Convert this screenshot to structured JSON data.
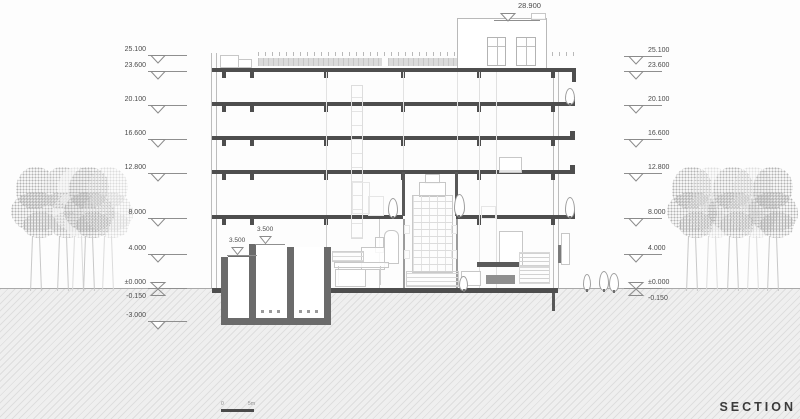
{
  "title": {
    "section_label": "SECTION"
  },
  "scalebar": {
    "start": "0",
    "end": "5m"
  },
  "roof_marker": {
    "label": "28.900"
  },
  "elevations": {
    "left": [
      {
        "label": "25.100",
        "y": 56,
        "sym": "tri"
      },
      {
        "label": "23.600",
        "y": 72,
        "sym": "tri"
      },
      {
        "label": "20.100",
        "y": 106,
        "sym": "tri"
      },
      {
        "label": "16.600",
        "y": 140,
        "sym": "tri"
      },
      {
        "label": "12.800",
        "y": 174,
        "sym": "tri"
      },
      {
        "label": "8.000",
        "y": 219,
        "sym": "tri"
      },
      {
        "label": "4.000",
        "y": 255,
        "sym": "tri"
      },
      {
        "label": "±0.000",
        "y": 289,
        "sym": "x"
      },
      {
        "label": "-0.150",
        "y": 303,
        "sym": "none"
      },
      {
        "label": "-3.000",
        "y": 322,
        "sym": "tri"
      }
    ],
    "right": [
      {
        "label": "25.100",
        "y": 57,
        "sym": "tri"
      },
      {
        "label": "23.600",
        "y": 72,
        "sym": "tri"
      },
      {
        "label": "20.100",
        "y": 106,
        "sym": "tri"
      },
      {
        "label": "16.600",
        "y": 140,
        "sym": "tri"
      },
      {
        "label": "12.800",
        "y": 174,
        "sym": "tri"
      },
      {
        "label": "8.000",
        "y": 219,
        "sym": "tri"
      },
      {
        "label": "4.000",
        "y": 255,
        "sym": "tri"
      },
      {
        "label": "±0.000",
        "y": 289,
        "sym": "x"
      },
      {
        "label": "-0.150",
        "y": 305,
        "sym": "none"
      }
    ],
    "interior": [
      {
        "label": "3.500",
        "x": 241,
        "liney": 256
      },
      {
        "label": "3.500",
        "x": 269,
        "liney": 245
      }
    ]
  },
  "colors": {
    "slab": "#4e4e4e",
    "basement_wall": "#6b6b6b",
    "ground_hatch": "#dedede",
    "text": "#4a4a4a"
  }
}
